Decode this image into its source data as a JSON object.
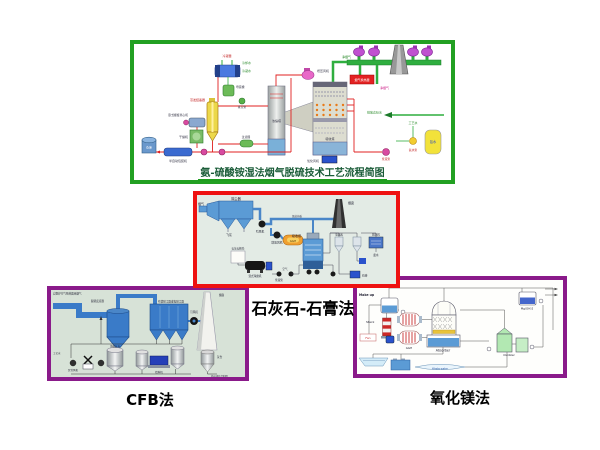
{
  "page": {
    "background": "#ffffff"
  },
  "panels": {
    "ammonia": {
      "caption": "氨-硫酸铵湿法烟气脱硫技术工艺流程简图",
      "border_color": "#22a022",
      "labels": {
        "cooling_water": "冷却水",
        "condensate": "冷凝水",
        "condenser": "冷凝器",
        "vacuum_pump": "真空泵",
        "mother_tank": "母液槽",
        "crystallizer": "蒸发结晶器",
        "centrifuge": "卧式螺旋离心机",
        "dryer": "干燥机",
        "packer": "半自动包装机",
        "warehouse": "仓库",
        "slurry_pump": "浆液泵",
        "filter": "过滤器",
        "concentrator": "浓缩塔",
        "absorber": "吸收塔",
        "booster_fan": "增压风机",
        "heater": "烟气换热器",
        "clean_gas": "净烟气",
        "oxidation_fan": "氧化风机",
        "discharge": "排放达标水",
        "process_water": "工艺水",
        "ammonia_tank": "氨水",
        "ammonia_pump": "氨水泵"
      }
    },
    "limestone": {
      "title": "石灰石-石膏法",
      "border_color": "#ee1111",
      "labels": {
        "esp": "除尘器",
        "flue_gas": "烟气",
        "fly_ash": "飞灰",
        "id_fan": "引风机",
        "booster_fan": "增压风机",
        "ggh": "GGH",
        "stack": "烟囱",
        "damper": "烟道挡板",
        "absorber": "吸收塔",
        "limestone_silo": "石灰石粉仓",
        "mill": "湿式球磨机",
        "slurry_pump": "浆液泵",
        "air": "空气",
        "cyclone": "旋流器",
        "dewater": "脱水机",
        "waste_water": "废水",
        "gypsum": "石膏"
      }
    },
    "cfb": {
      "title": "CFB法",
      "border_color": "#8a1a8a",
      "labels": {
        "inlet": "自锅炉空气预热器来烟气",
        "reactor": "脱硫反应器",
        "filter": "布袋除尘器或电除尘器",
        "id_fan": "引风机",
        "stack": "烟囱",
        "ash_silo": "灰仓",
        "ash_out": "外运或综合利用",
        "lime_silo": "消石灰仓",
        "water": "工艺水",
        "feeder": "给料机",
        "blower": "罗茨风机"
      }
    },
    "mgo": {
      "title": "氧化镁法",
      "border_color": "#8a1a8a",
      "labels": {
        "make_up": "Make up",
        "stack": "Stack",
        "fan": "Fan",
        "ggh": "GGH",
        "absorber": "Absorber",
        "slurry": "Mg(OH)2",
        "oxidizer": "Oxidizer",
        "waste": "Waste water"
      }
    }
  }
}
